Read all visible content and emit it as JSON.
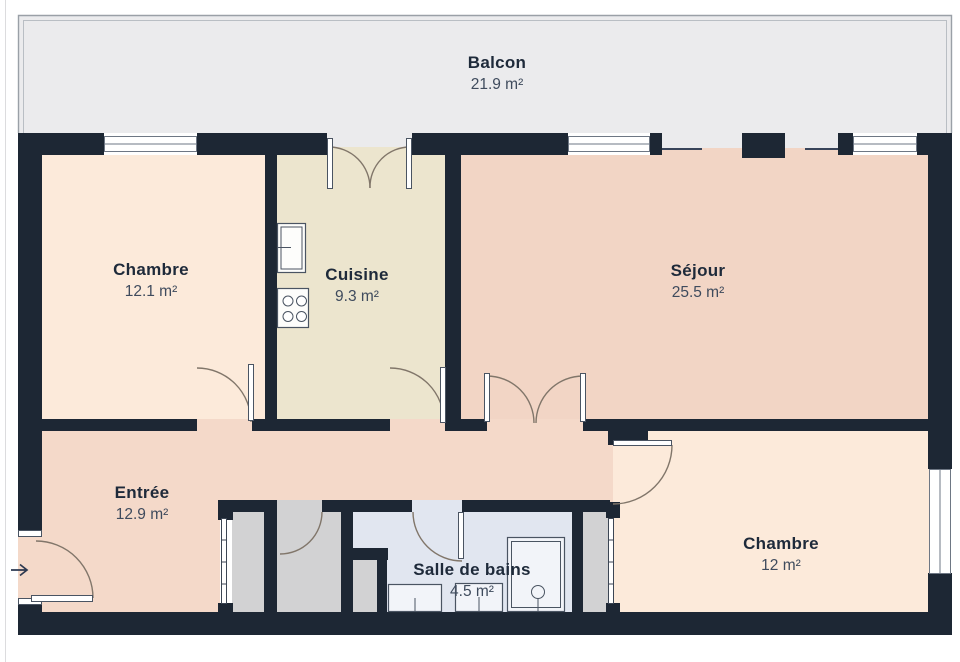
{
  "rooms": [
    {
      "name": "Balcon",
      "area": "21.9 m²",
      "color": "#ebebed"
    },
    {
      "name": "Chambre",
      "area": "12.1 m²",
      "color": "#fceada"
    },
    {
      "name": "Cuisine",
      "area": "9.3 m²",
      "color": "#ece5ce"
    },
    {
      "name": "Séjour",
      "area": "25.5 m²",
      "color": "#f2d5c5"
    },
    {
      "name": "Entrée",
      "area": "12.9 m²",
      "color": "#f4d9c9"
    },
    {
      "name": "Chambre",
      "area": "12 m²",
      "color": "#fceada"
    },
    {
      "name": "Salle de bains",
      "area": "4.5 m²",
      "color": "#e1e6f0"
    }
  ],
  "colors": {
    "wall": "#1d2734",
    "closet": "#d2d2d3",
    "balcony_border": "#9aa0a7",
    "door_arc": "#81766a",
    "frame_stroke": "#4a5462",
    "window_stroke": "#6e7784",
    "label_name": "#1e2a3a",
    "label_area": "#3f4b5d",
    "background": "#ffffff"
  },
  "icons": {
    "entrance_indicator": "arrow-right"
  }
}
